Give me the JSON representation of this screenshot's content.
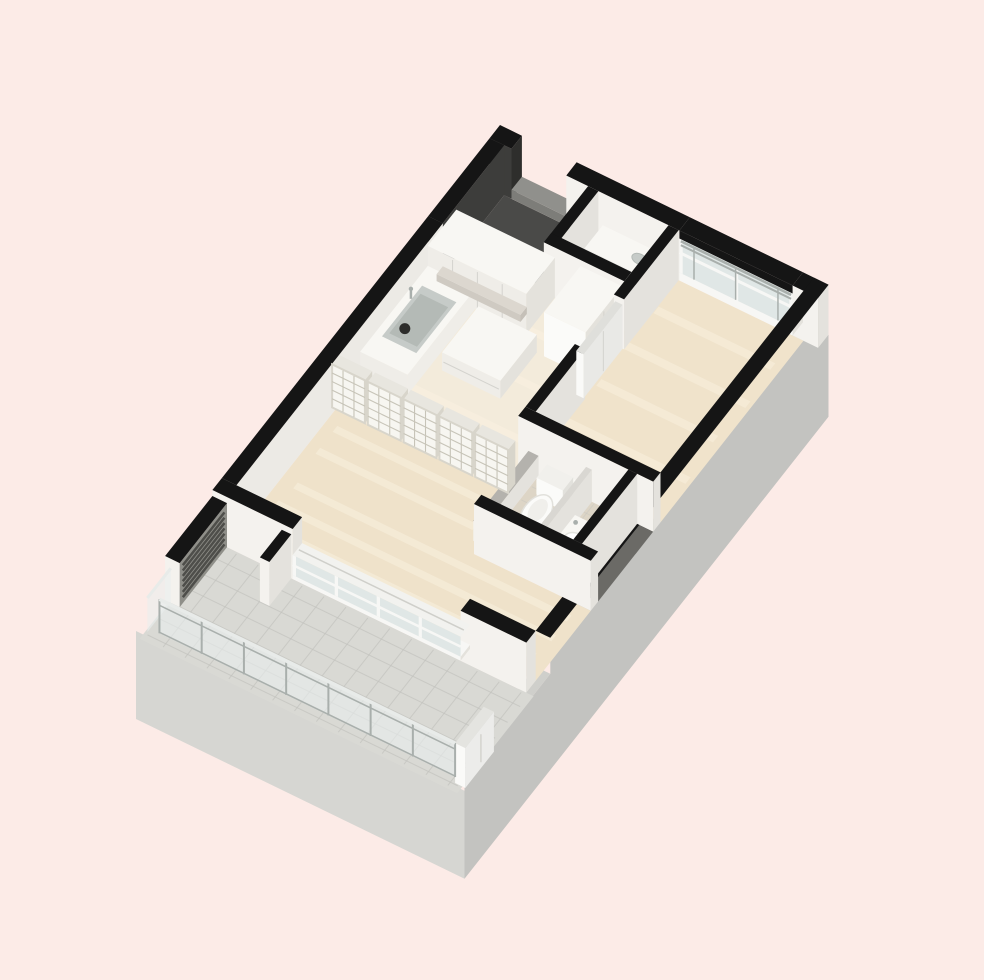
{
  "scene": {
    "type": "isometric-3d-floorplan",
    "view": "cutaway-top",
    "background": "#fcebe7"
  },
  "colors": {
    "background": "#fcebe7",
    "slab_se": "#c3c3c0",
    "slab_sw": "#d6d6d2",
    "parapet_top": "#cfcfcb",
    "wall_top": "#151515",
    "wall_face_sw": "#f4f2ee",
    "wall_face_se": "#e4e2dd",
    "dark_wall_face": "#3d3d3b",
    "dark_wall_face2": "#2e2e2c",
    "plank_streak": "#faf1e0",
    "tile_line": "#c2c2bd",
    "glass": "#e0e7e6",
    "window_frame": "#f7f7f5",
    "rail_metal": "#a9afac",
    "rail_top": "#e8ebe9",
    "railing_glass": "#e9efee",
    "counter_top": "#f8f7f3",
    "counter_front": "#efede8",
    "counter_side": "#e4e2dc",
    "steel": "#c6cbc8",
    "steel_inner": "#b4bab6",
    "drain": "#2d2d2b",
    "shoji_pane": "#f7f6f1",
    "shoji_frame": "#d8d5cb",
    "shoji_grid": "#c7c4b8",
    "shoji_top": "#e8e6df",
    "fixture": "#fbfbf9",
    "fixture_shade": "#e2e1dc",
    "fixture_line": "#d4d3ce",
    "louver_base": "#8f8f89",
    "louver_slat": "#4e4e4a",
    "door_leaf": "#fafaf8",
    "cut_top": "#b4b2ad",
    "step_top": "#dcd7cf",
    "opening_top": "#90908c",
    "opening_face": "#7d7d79"
  },
  "rooms": [
    {
      "id": "entrance",
      "floor_color": "#4a4a48"
    },
    {
      "id": "washroom",
      "floor_color": "#edebe7"
    },
    {
      "id": "kitchen",
      "floor_color": "#f3ebdb"
    },
    {
      "id": "bedroom",
      "floor_color": "#f0e3cb"
    },
    {
      "id": "bathroom",
      "floor_color": "#ddd5c6"
    },
    {
      "id": "closet",
      "floor_color": "#6b6a66"
    },
    {
      "id": "living-room",
      "floor_color": "#efe2ca"
    },
    {
      "id": "balcony",
      "floor_color": "#d9d9d4"
    },
    {
      "id": "storage-alcove",
      "floor_color": "#d9d9d4"
    }
  ],
  "fixtures": [
    {
      "id": "entrance-door-opening"
    },
    {
      "id": "entrance-step"
    },
    {
      "id": "washroom-counter"
    },
    {
      "id": "washing-machine"
    },
    {
      "id": "kitchen-cabinets"
    },
    {
      "id": "refrigerator-cabinet"
    },
    {
      "id": "kitchen-sink-counter"
    },
    {
      "id": "kitchen-island"
    },
    {
      "id": "bedroom-door"
    },
    {
      "id": "bedroom-window",
      "panes": 2
    },
    {
      "id": "toilet"
    },
    {
      "id": "bathroom-vanity"
    },
    {
      "id": "bathroom-partition"
    },
    {
      "id": "shoji-partition",
      "panels": 5,
      "grid_rows": 4,
      "grid_cols": 2
    },
    {
      "id": "balcony-sliding-windows",
      "panes": 4
    },
    {
      "id": "louver-panel",
      "slats": 7
    },
    {
      "id": "balcony-railing",
      "posts": 8
    },
    {
      "id": "balcony-partition-panel"
    }
  ]
}
